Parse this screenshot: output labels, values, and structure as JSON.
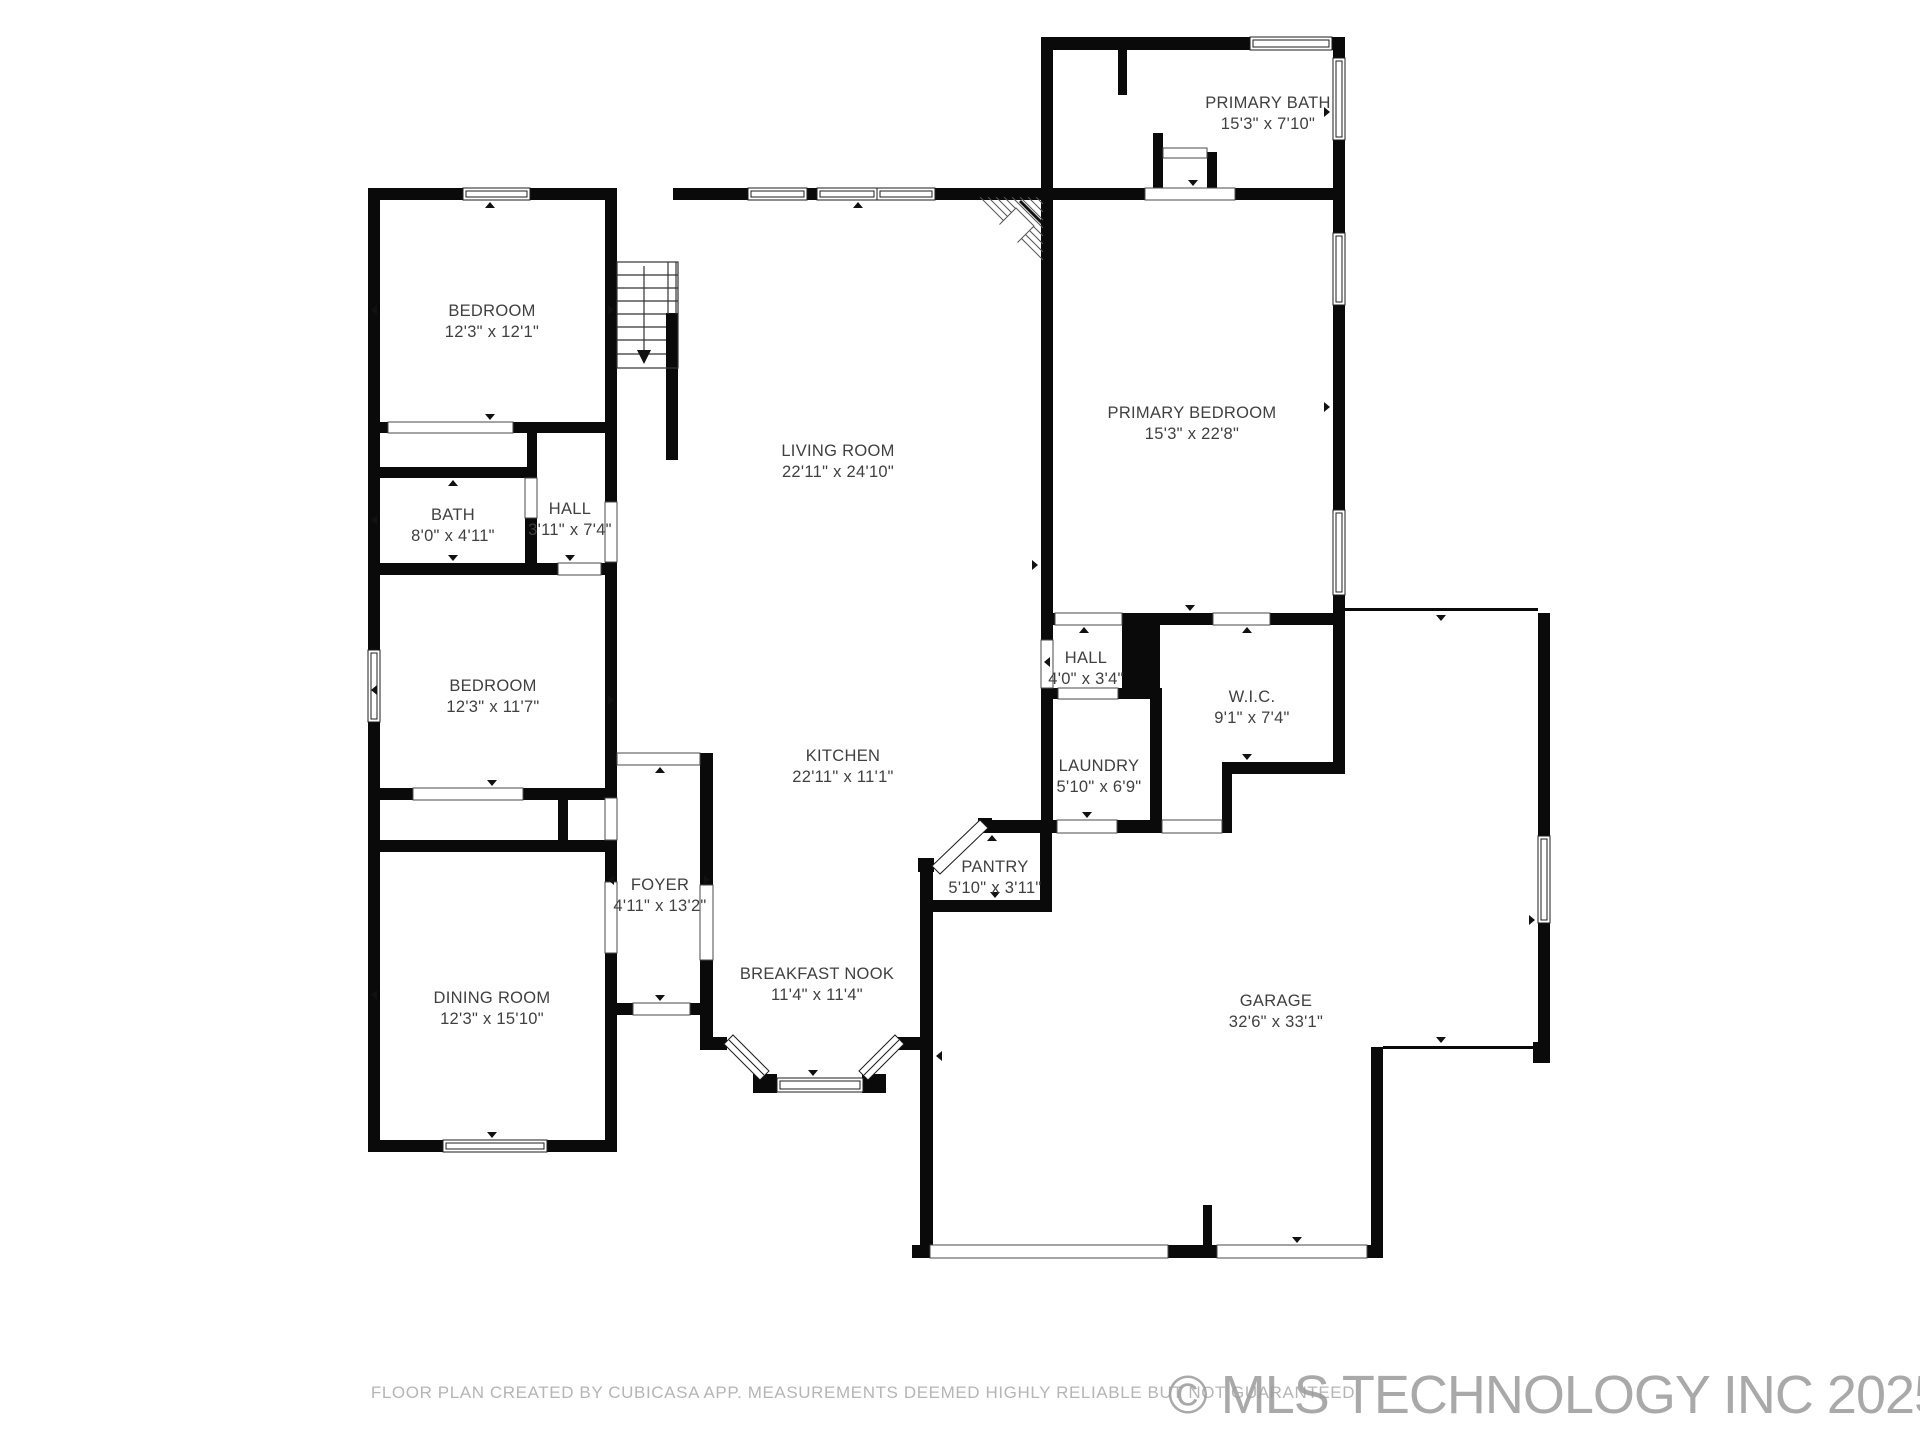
{
  "rooms": [
    {
      "name": "PRIMARY BATH",
      "dims": "15'3\" x 7'10\""
    },
    {
      "name": "BEDROOM",
      "dims": "12'3\" x 12'1\""
    },
    {
      "name": "LIVING ROOM",
      "dims": "22'11\" x 24'10\""
    },
    {
      "name": "PRIMARY BEDROOM",
      "dims": "15'3\" x 22'8\""
    },
    {
      "name": "BATH",
      "dims": "8'0\" x 4'11\""
    },
    {
      "name": "HALL",
      "dims": "3'11\" x 7'4\""
    },
    {
      "name": "BEDROOM",
      "dims": "12'3\" x 11'7\""
    },
    {
      "name": "HALL",
      "dims": "4'0\" x 3'4\""
    },
    {
      "name": "W.I.C.",
      "dims": "9'1\" x 7'4\""
    },
    {
      "name": "KITCHEN",
      "dims": "22'11\" x 11'1\""
    },
    {
      "name": "LAUNDRY",
      "dims": "5'10\" x 6'9\""
    },
    {
      "name": "PANTRY",
      "dims": "5'10\" x 3'11\""
    },
    {
      "name": "FOYER",
      "dims": "4'11\" x 13'2\""
    },
    {
      "name": "BREAKFAST NOOK",
      "dims": "11'4\" x 11'4\""
    },
    {
      "name": "DINING ROOM",
      "dims": "12'3\" x 15'10\""
    },
    {
      "name": "GARAGE",
      "dims": "32'6\" x 33'1\""
    }
  ],
  "footer": {
    "disclaimer": "FLOOR PLAN CREATED BY CUBICASA APP. MEASUREMENTS DEEMED HIGHLY RELIABLE BUT NOT GUARANTEED"
  },
  "watermark": {
    "text": "© MLS TECHNOLOGY INC 2025"
  },
  "colors": {
    "wall": "#0a0a0a",
    "label": "#404040",
    "footer_text": "#b5b5b5",
    "watermark_text": "#9b9b9b",
    "background": "#ffffff"
  }
}
